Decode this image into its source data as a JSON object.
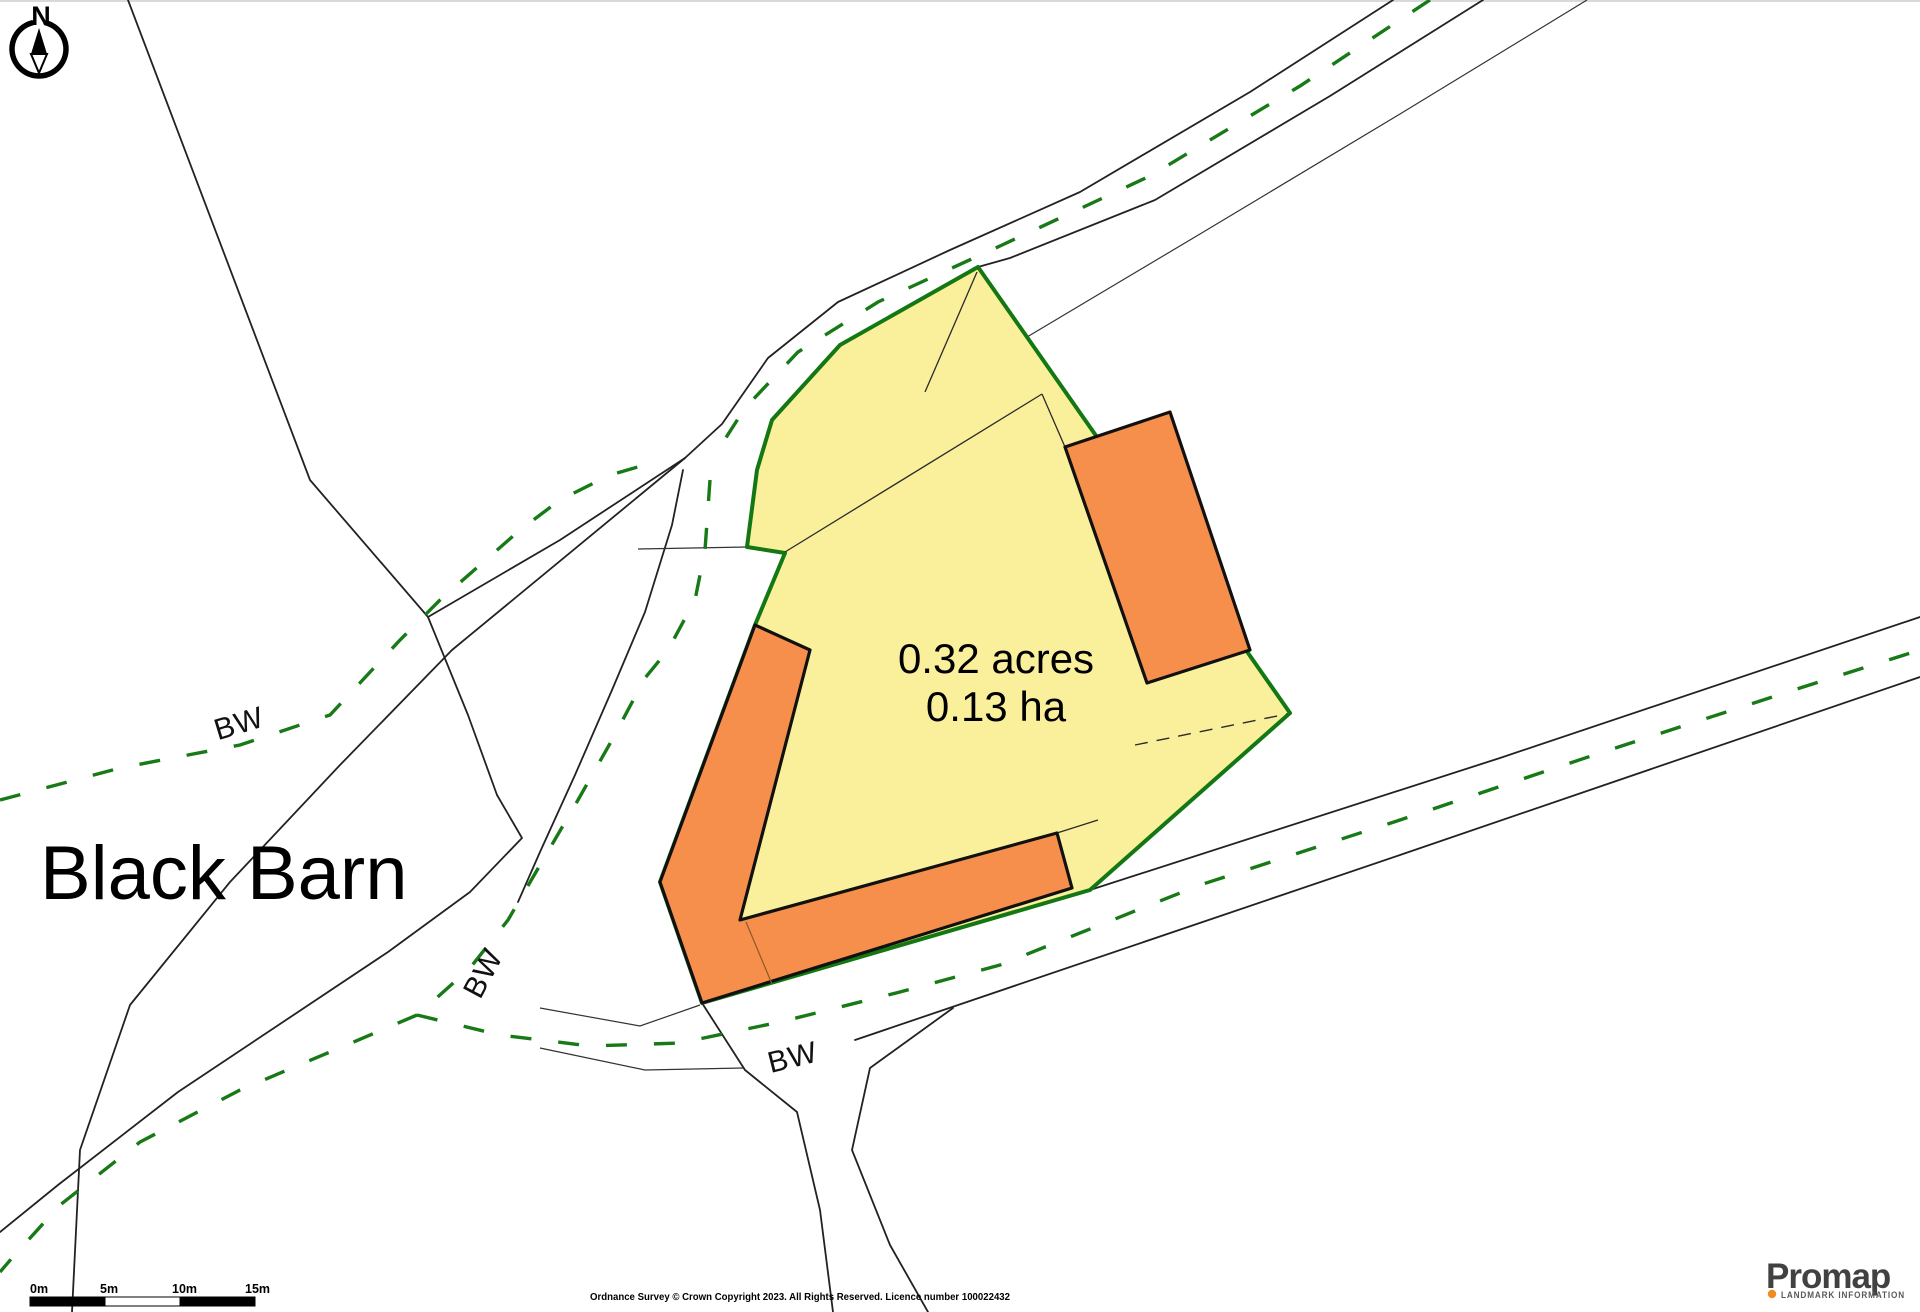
{
  "map": {
    "compass_label": "N",
    "place_label": "Black Barn",
    "plot": {
      "area_acres": "0.32 acres",
      "area_ha": "0.13 ha"
    },
    "bridleways": {
      "bw_west": "BW",
      "bw_southwest": "BW",
      "bw_south": "BW"
    },
    "colors": {
      "plot_fill": "#FAF09B",
      "plot_boundary_green": "#137813",
      "building_fill": "#F68F4C",
      "bridleway_dash_green": "#177A17",
      "road_line_black": "#222222",
      "logo_orange": "#F18A21"
    }
  },
  "scale_bar": {
    "labels": [
      "0m",
      "5m",
      "10m",
      "15m"
    ]
  },
  "footer": {
    "copyright_text": "Ordnance Survey © Crown Copyright 2023. All Rights Reserved. Licence number 100022432"
  },
  "branding": {
    "logo_text": "Promap",
    "tagline": "LANDMARK INFORMATION"
  }
}
